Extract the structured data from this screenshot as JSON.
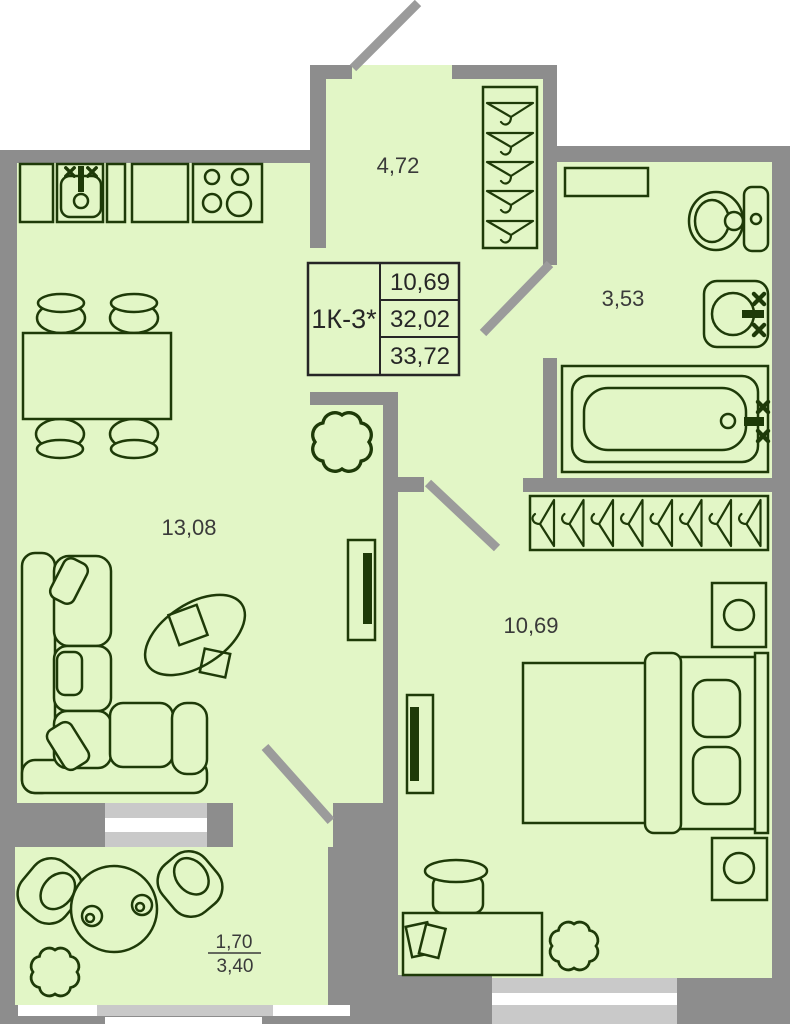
{
  "plan": {
    "type": "apartment-floor-plan",
    "unit": {
      "code": "1К-3*",
      "living_area": "10,69",
      "apartment_area": "32,02",
      "total_area": "33,72"
    },
    "rooms": [
      {
        "id": "hallway",
        "area": "4,72"
      },
      {
        "id": "bathroom",
        "area": "3,53"
      },
      {
        "id": "kitchen-living-room",
        "area": "13,08"
      },
      {
        "id": "bedroom",
        "area": "10,69"
      },
      {
        "id": "balcony",
        "area_reduced": "1,70",
        "area_full": "3,40"
      }
    ],
    "fixtures": [
      "kitchen-counter",
      "kitchen-sink",
      "stove",
      "dining-table",
      "dining-chair",
      "sofa",
      "coffee-table",
      "tv",
      "plant",
      "wardrobe-hangers",
      "toilet",
      "washbasin",
      "bathtub",
      "shelf",
      "bed",
      "nightstand-lamp",
      "desk",
      "desk-chair",
      "book",
      "balcony-table",
      "cup",
      "armchair",
      "door-swing",
      "window"
    ],
    "colors": {
      "room_fill": "#e2f6c6",
      "wall": "#8d8d8d",
      "window": "#c9c9c9",
      "furniture_outline": "#1e3a08",
      "label_text": "#3a3a3a",
      "background": "#ffffff"
    }
  }
}
